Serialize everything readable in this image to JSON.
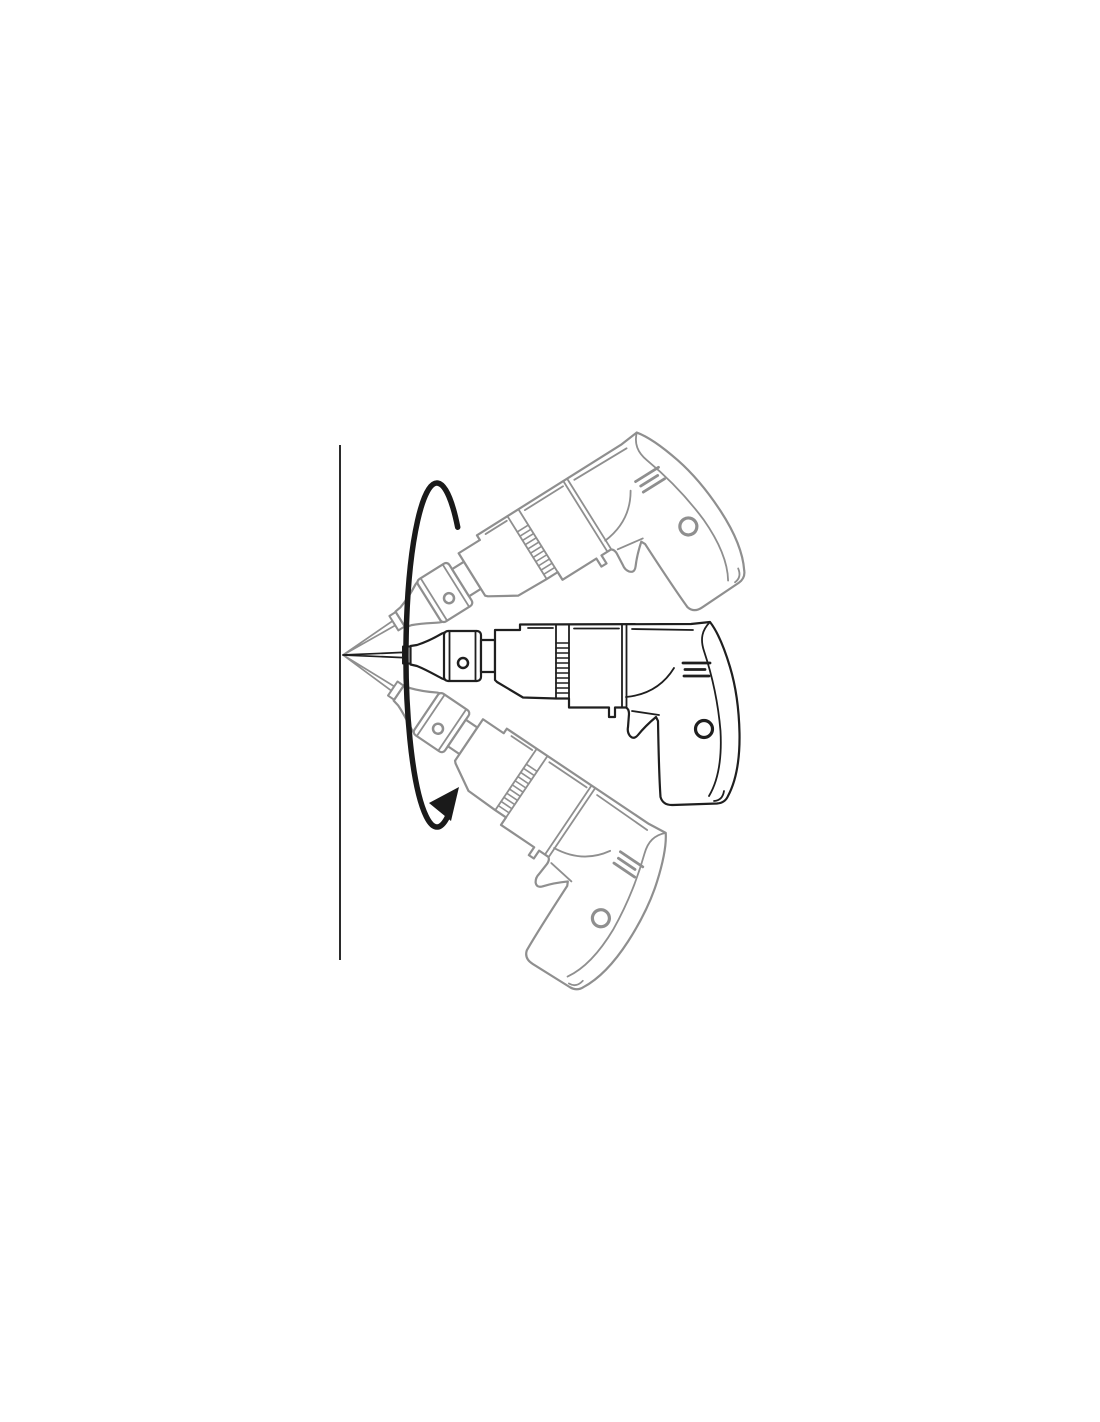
{
  "colors": {
    "background": "#ffffff",
    "primary": "#1f1f1f",
    "ghost": "#8f8f8f",
    "arrow": "#1a1a1a",
    "wall": "#2b2b2b",
    "fill": "#ffffff"
  },
  "wall": {
    "x": 340,
    "y1": 445,
    "y2": 960,
    "stroke_width": 2
  },
  "pivot": {
    "x": 343,
    "y": 655
  },
  "drills": {
    "upper_ghost": {
      "angle_deg": -32,
      "transform": "translate(343,655) rotate(-32)",
      "color": "#8f8f8f"
    },
    "main": {
      "angle_deg": 0,
      "transform": "translate(343,655) rotate(0)",
      "color": "#1f1f1f"
    },
    "lower_ghost": {
      "angle_deg": 34,
      "transform": "translate(343,655) rotate(34)",
      "color": "#8f8f8f"
    }
  },
  "rotation_arrow": {
    "path": "M 457.7 527.2 A 31 172 0 1 0 447.6 816.6",
    "stroke_width": 5.5,
    "color": "#1a1a1a",
    "arrowhead_points": "459,787 429,803 451,821"
  }
}
